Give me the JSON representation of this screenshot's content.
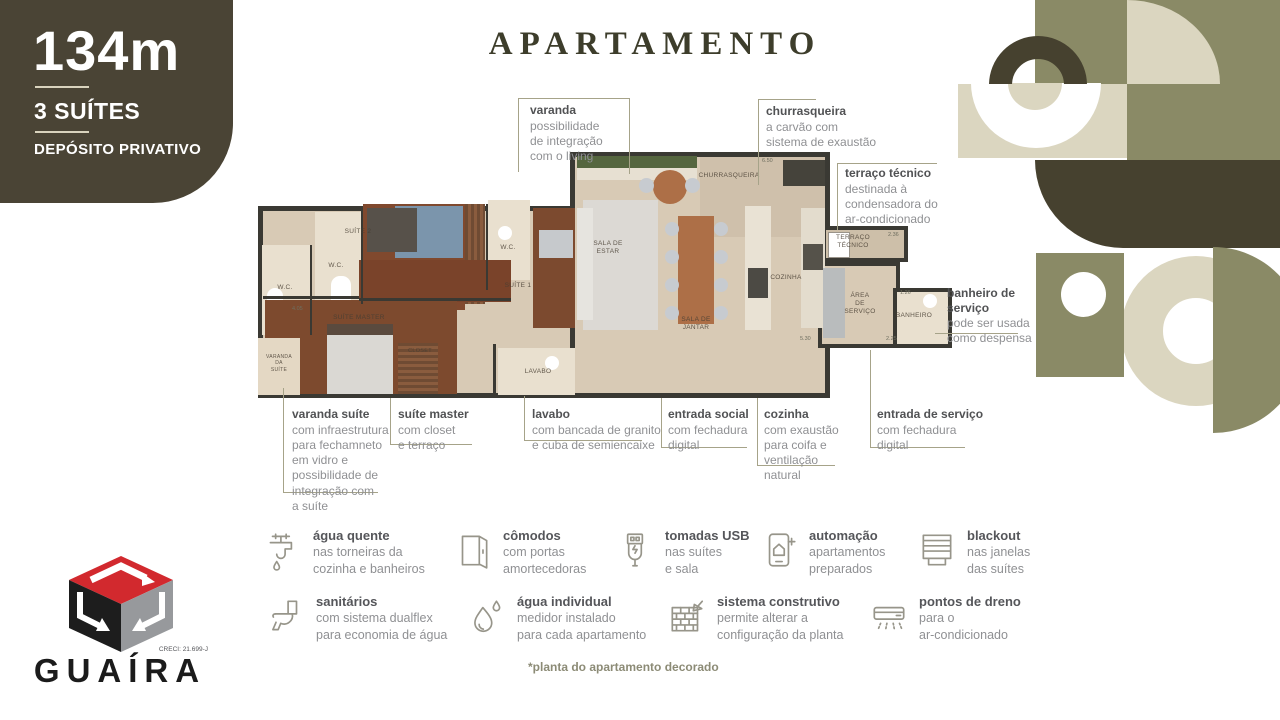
{
  "badge": {
    "area": "134m",
    "suites": "3 SUÍTES",
    "deposito": "DEPÓSITO PRIVATIVO"
  },
  "title": "APARTAMENTO",
  "callouts": [
    {
      "title": "varanda",
      "desc": "possibilidade\nde integração\ncom o living"
    },
    {
      "title": "churrasqueira",
      "desc": "a carvão com\nsistema de exaustão"
    },
    {
      "title": "terraço técnico",
      "desc": "destinada à\ncondensadora do\nar-condicionado"
    },
    {
      "title": "banheiro de\nserviço",
      "desc": "pode ser usada\ncomo despensa"
    },
    {
      "title": "varanda suíte",
      "desc": "com infraestrutura\npara fechamneto\nem vidro e\npossibilidade de\nintegração com\na suíte"
    },
    {
      "title": "suíte master",
      "desc": "com closet\ne terraço"
    },
    {
      "title": "lavabo",
      "desc": "com bancada de granito\ne cuba de semiencaixe"
    },
    {
      "title": "entrada social",
      "desc": "com fechadura\ndigital"
    },
    {
      "title": "cozinha",
      "desc": "com exaustão\npara coifa e\nventilação\nnatural"
    },
    {
      "title": "entrada de serviço",
      "desc": "com fechadura\ndigital"
    }
  ],
  "plan": {
    "rooms": [
      {
        "label": "SALA DE\nESTAR"
      },
      {
        "label": "SALA DE\nJANTAR"
      },
      {
        "label": "COZINHA"
      },
      {
        "label": "CHURRASQUEIRA"
      },
      {
        "label": "TERRAÇO\nTÉCNICO"
      },
      {
        "label": "ÁREA\nDE\nSERVIÇO"
      },
      {
        "label": "BANHEIRO"
      },
      {
        "label": "SUÍTE MASTER"
      },
      {
        "label": "CLOSET"
      },
      {
        "label": "LAVABO"
      },
      {
        "label": "SUÍTE 1"
      },
      {
        "label": "SUÍTE 2"
      },
      {
        "label": "W.C."
      },
      {
        "label": "W.C."
      },
      {
        "label": "W.C."
      },
      {
        "label": "VARANDA\nDA\nSUÍTE"
      }
    ],
    "dims": [
      "6.50",
      "2.36",
      "5.30",
      "2.25",
      "1.26",
      "4.05"
    ]
  },
  "features": [
    {
      "title": "água quente",
      "desc": "nas torneiras da\ncozinha e banheiros"
    },
    {
      "title": "cômodos",
      "desc": "com portas\namortecedoras"
    },
    {
      "title": "tomadas USB",
      "desc": "nas suítes\ne sala"
    },
    {
      "title": "automação",
      "desc": "apartamentos\npreparados"
    },
    {
      "title": "blackout",
      "desc": "nas janelas\ndas suítes"
    },
    {
      "title": "sanitários",
      "desc": "com sistema dualflex\npara economia de água"
    },
    {
      "title": "água individual",
      "desc": "medidor instalado\npara cada apartamento"
    },
    {
      "title": "sistema construtivo",
      "desc": "permite alterar a\nconfiguração da planta"
    },
    {
      "title": "pontos de dreno",
      "desc": "para o\nar-condicionado"
    }
  ],
  "logo": {
    "brand": "GUAÍRA",
    "creci": "CRECI: 21.699-J"
  },
  "footnote": "*planta do apartamento decorado",
  "colors": {
    "badge": "#4A4435",
    "olive": "#8A8A66",
    "dark_olive": "#46412F",
    "cream": "#DBD6C0",
    "accent_red": "#D2292E",
    "line": "#A6A389",
    "title": "#3D3D2B"
  }
}
